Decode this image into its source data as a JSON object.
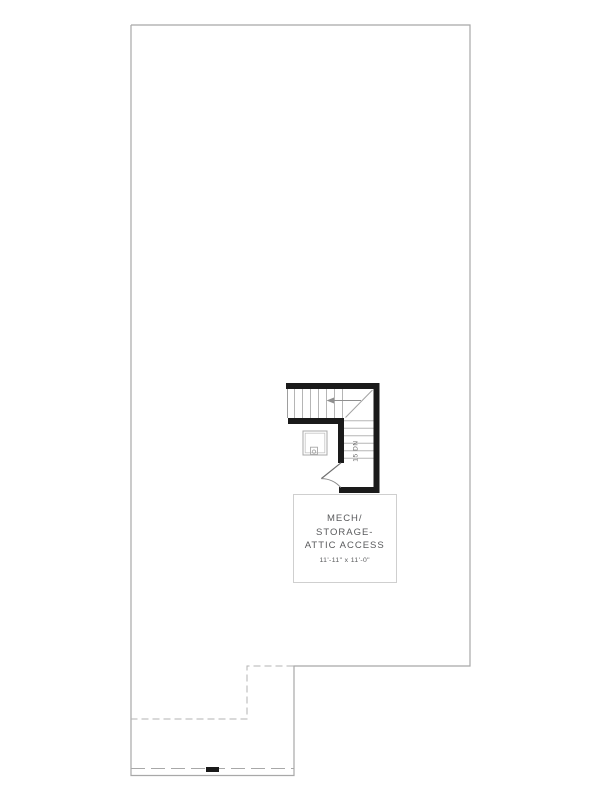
{
  "floor_plan": {
    "room_label": {
      "name_lines": [
        "MECH/",
        "STORAGE-",
        "ATTIC ACCESS"
      ],
      "dimensions": "11'-11\" x 11'-0\""
    },
    "stair_annotation": "15 DN",
    "colors": {
      "background": "#ffffff",
      "wall": "#1a1a1a",
      "outline": "#a8a8a8",
      "stair_lines": "#b5b5b5",
      "door_lines": "#7a7a7a",
      "label_text": "#595a5c",
      "label_box_border": "#cfcfcf"
    }
  }
}
